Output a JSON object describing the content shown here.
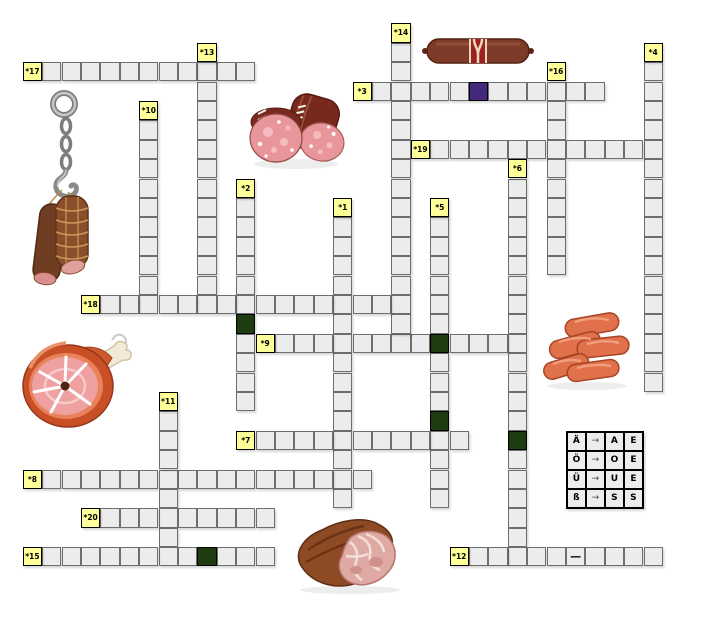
{
  "puzzle": {
    "words": [
      {
        "number": "*1",
        "dir": "down",
        "col": 16,
        "row": 9,
        "len": 16
      },
      {
        "number": "*2",
        "dir": "down",
        "col": 11,
        "row": 8,
        "len": 12
      },
      {
        "number": "*3",
        "dir": "across",
        "col": 17,
        "row": 3,
        "len": 13
      },
      {
        "number": "*4",
        "dir": "down",
        "col": 32,
        "row": 1,
        "len": 18
      },
      {
        "number": "*5",
        "dir": "down",
        "col": 21,
        "row": 9,
        "len": 16
      },
      {
        "number": "*6",
        "dir": "down",
        "col": 25,
        "row": 7,
        "len": 21
      },
      {
        "number": "*7",
        "dir": "across",
        "col": 11,
        "row": 21,
        "len": 12
      },
      {
        "number": "*8",
        "dir": "across",
        "col": 0,
        "row": 23,
        "len": 18
      },
      {
        "number": "*9",
        "dir": "across",
        "col": 12,
        "row": 16,
        "len": 14
      },
      {
        "number": "*10",
        "dir": "down",
        "col": 6,
        "row": 4,
        "len": 11
      },
      {
        "number": "*11",
        "dir": "down",
        "col": 7,
        "row": 19,
        "len": 9
      },
      {
        "number": "*12",
        "dir": "across",
        "col": 22,
        "row": 27,
        "len": 11
      },
      {
        "number": "*13",
        "dir": "down",
        "col": 9,
        "row": 1,
        "len": 14
      },
      {
        "number": "*14",
        "dir": "down",
        "col": 19,
        "row": 0,
        "len": 17
      },
      {
        "number": "*15",
        "dir": "across",
        "col": 0,
        "row": 27,
        "len": 13
      },
      {
        "number": "*16",
        "dir": "down",
        "col": 27,
        "row": 2,
        "len": 11
      },
      {
        "number": "*17",
        "dir": "across",
        "col": 0,
        "row": 2,
        "len": 12
      },
      {
        "number": "*18",
        "dir": "across",
        "col": 3,
        "row": 14,
        "len": 17
      },
      {
        "number": "*19",
        "dir": "across",
        "col": 20,
        "row": 6,
        "len": 13
      },
      {
        "number": "*20",
        "dir": "across",
        "col": 3,
        "row": 25,
        "len": 10
      }
    ],
    "special_cells": [
      {
        "col": 23,
        "row": 3,
        "type": "purple"
      },
      {
        "col": 11,
        "row": 15,
        "type": "green"
      },
      {
        "col": 21,
        "row": 16,
        "type": "green"
      },
      {
        "col": 21,
        "row": 20,
        "type": "green"
      },
      {
        "col": 25,
        "row": 21,
        "type": "green"
      },
      {
        "col": 9,
        "row": 27,
        "type": "green"
      },
      {
        "col": 28,
        "row": 27,
        "type": "dash",
        "text": "—"
      }
    ]
  },
  "legend": {
    "position": {
      "col": 28,
      "row": 21
    },
    "rows": [
      [
        "Ä",
        "→",
        "A",
        "E"
      ],
      [
        "Ö",
        "→",
        "O",
        "E"
      ],
      [
        "Ü",
        "→",
        "U",
        "E"
      ],
      [
        "ß",
        "→",
        "S",
        "S"
      ]
    ]
  },
  "colors": {
    "cell_bg": "#ececec",
    "number_bg": "#ffff99",
    "separator_green": "#1e3c10",
    "special_purple": "#44287b",
    "border": "#6e6e6e"
  },
  "illustrations": [
    {
      "name": "hanging-cured-sausages"
    },
    {
      "name": "salami-slices"
    },
    {
      "name": "sausage-stick"
    },
    {
      "name": "ham-hock"
    },
    {
      "name": "sausage-pile"
    },
    {
      "name": "roast-meat"
    }
  ]
}
